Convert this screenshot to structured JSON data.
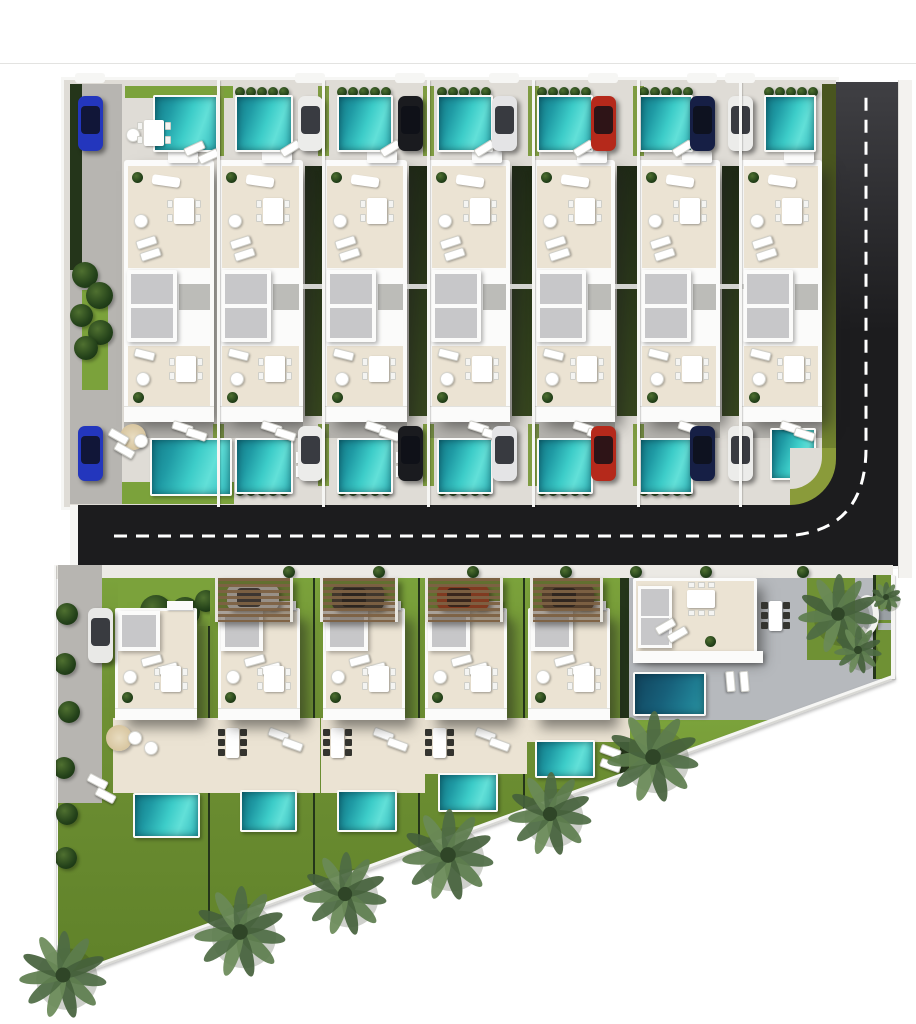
{
  "title": "villa-development-site-plan",
  "palette": {
    "white": "#fbfbfa",
    "wall": "#f6f6f4",
    "concrete": "#dfdcd6",
    "beige": "#ebe3d3",
    "skylight": "#c7c7c9",
    "road": "#1c1c1e",
    "dash": "#ffffff",
    "lawn": "#6f9134",
    "lawnB": "#7ba23b",
    "lawnStrip": "#7f9c42",
    "hedgeDark": "#24351a",
    "gapHedge1": "#1f2a16",
    "gapHedge2": "#37471f",
    "olive": "#8a9b3a",
    "drive": "#b7b5b1",
    "sidewalk": "#eceae5",
    "glass": "rgba(12,15,22,0.80)",
    "walkway": "#bcbcb8",
    "greyTerrace": "#b6b9bd"
  },
  "hairline_y": 63,
  "road": {
    "vertical": [
      836,
      82,
      62,
      486
    ],
    "horizontal": [
      78,
      505,
      820,
      63
    ],
    "dash_path": "M114 536 H 778 Q 866 536 866 448 V 94",
    "bottom_wall": [
      78,
      566,
      820,
      3
    ],
    "left_cap": [
      70,
      505,
      8,
      64
    ],
    "right_sidewalk": [
      898,
      80,
      14,
      498
    ]
  },
  "top_parcel": {
    "x": 64,
    "y": 80,
    "w": 772,
    "h": 427,
    "margin": [
      {
        "t": "rect",
        "b": [
          6,
          4,
          52,
          420
        ],
        "c": "drive"
      },
      {
        "t": "rect",
        "b": [
          6,
          4,
          12,
          186
        ],
        "c": "hedgeDark"
      },
      {
        "t": "rect",
        "b": [
          18,
          210,
          26,
          100
        ],
        "c": "lawnB"
      },
      {
        "t": "bush",
        "b": [
          8,
          182,
          26
        ]
      },
      {
        "t": "bush",
        "b": [
          22,
          202,
          27
        ]
      },
      {
        "t": "bush",
        "b": [
          6,
          224,
          23
        ]
      },
      {
        "t": "bush",
        "b": [
          24,
          240,
          25
        ]
      },
      {
        "t": "bush",
        "b": [
          10,
          256,
          24
        ]
      },
      {
        "t": "rect",
        "b": [
          758,
          4,
          14,
          418
        ],
        "c": "oliveGrad"
      }
    ],
    "columns": [
      {
        "name": "villa-1",
        "x0": 6,
        "x1": 154,
        "bldg": [
          60,
          90
        ],
        "pool": [
          89,
          65
        ],
        "pool_b": [
          86,
          358,
          82,
          58
        ],
        "car_x": 14,
        "car": "#2336bd",
        "std": false,
        "hedges": false,
        "extras": [
          {
            "t": "rect",
            "b": [
              61,
              6,
              108,
              12
            ],
            "c": "lawnB"
          },
          {
            "t": "roundtable",
            "b": [
              62,
              48
            ]
          },
          {
            "t": "diningW",
            "b": [
              80,
              40
            ]
          },
          {
            "t": "lounger",
            "b": [
              120,
              64,
              -25
            ]
          },
          {
            "t": "lounger",
            "b": [
              134,
              72,
              -25
            ]
          },
          {
            "t": "parasol",
            "b": [
              56,
              344
            ]
          },
          {
            "t": "roundtable",
            "b": [
              70,
              354
            ]
          },
          {
            "t": "lounger",
            "b": [
              44,
              352,
              30
            ]
          },
          {
            "t": "lounger",
            "b": [
              50,
              366,
              30
            ]
          },
          {
            "t": "rect",
            "b": [
              58,
              402,
              112,
              22
            ],
            "c": "lawnB"
          }
        ]
      },
      {
        "name": "villa-2",
        "x0": 154,
        "x1": 259,
        "bldg": [
          154,
          85
        ],
        "pool": [
          171,
          58
        ],
        "car_x": 234,
        "car": "#ececea",
        "std": true,
        "hedges": true,
        "extras": []
      },
      {
        "name": "villa-3",
        "x0": 259,
        "x1": 364,
        "bldg": [
          259,
          84
        ],
        "pool": [
          273,
          56
        ],
        "car_x": 334,
        "car": "#1a1b1f",
        "std": true,
        "hedges": true,
        "extras": []
      },
      {
        "name": "villa-4",
        "x0": 364,
        "x1": 469,
        "bldg": [
          364,
          82
        ],
        "pool": [
          373,
          56
        ],
        "car_x": 428,
        "car": "#e4e4e6",
        "std": true,
        "hedges": true,
        "extras": []
      },
      {
        "name": "villa-5",
        "x0": 469,
        "x1": 574,
        "bldg": [
          469,
          82
        ],
        "pool": [
          473,
          56
        ],
        "car_x": 527,
        "car": "#b5291b",
        "std": true,
        "hedges": true,
        "extras": []
      },
      {
        "name": "villa-6",
        "x0": 574,
        "x1": 678,
        "bldg": [
          574,
          82
        ],
        "pool": [
          575,
          54
        ],
        "car_x": 626,
        "car": "#161f45",
        "std": true,
        "hedges": true,
        "extras": []
      },
      {
        "name": "villa-7",
        "x0": 676,
        "x1": 758,
        "bldg": [
          676,
          82
        ],
        "pool": [
          700,
          52
        ],
        "pool_b": [
          706,
          348,
          46,
          52
        ],
        "car_x": 664,
        "car": "#ececea",
        "std": false,
        "hedges": true,
        "extras": [
          {
            "t": "rect",
            "b": [
              726,
              368,
              46,
              59
            ],
            "c": "road"
          },
          {
            "t": "quad",
            "b": [
              726,
              368,
              46,
              57
            ]
          },
          {
            "t": "quadIn",
            "b": [
              726,
              368,
              32,
              41
            ]
          }
        ]
      }
    ]
  },
  "bottom_parcel": {
    "x": 40,
    "y": 565,
    "w": 860,
    "h": 450,
    "clip": "polygon(14px 0px, 853px 0px, 853px 113px, 14px 417px)",
    "sidewalk": [
      14,
      0,
      839,
      14
    ],
    "sidewalk_bushes": [
      243,
      333,
      427,
      520,
      590,
      660,
      757
    ],
    "ivy": [
      [
        16,
        38
      ],
      [
        14,
        88
      ],
      [
        18,
        136
      ],
      [
        13,
        192
      ],
      [
        16,
        238
      ],
      [
        15,
        282
      ]
    ],
    "lots": [
      {
        "name": "villa-8",
        "x0": 18,
        "x1": 170,
        "bldg": [
          75,
          82
        ],
        "pool": [
          93,
          228,
          67,
          45
        ],
        "patio_h": 75,
        "patio_f": false,
        "extras": [
          {
            "t": "rect",
            "b": [
              18,
              0,
              44,
              238
            ],
            "c": "drive"
          },
          {
            "t": "carV",
            "b": [
              48,
              43
            ],
            "c": "#e9e9e7"
          },
          {
            "t": "rect",
            "b": [
              78,
              13,
              92,
              48
            ],
            "c": "lawnB"
          },
          {
            "t": "bush",
            "b": [
              100,
              30,
              32
            ]
          },
          {
            "t": "bush",
            "b": [
              130,
              32,
              30
            ]
          },
          {
            "t": "bush",
            "b": [
              155,
              25,
              22
            ]
          },
          {
            "t": "parasol",
            "b": [
              66,
              160
            ]
          },
          {
            "t": "roundtable",
            "b": [
              88,
              166
            ]
          },
          {
            "t": "roundtable",
            "b": [
              104,
              176
            ]
          },
          {
            "t": "lounger",
            "b": [
              47,
              212,
              28
            ]
          },
          {
            "t": "lounger",
            "b": [
              55,
              226,
              28
            ]
          }
        ]
      },
      {
        "name": "villa-9",
        "x0": 170,
        "x1": 275,
        "bldg": [
          178,
          82
        ],
        "pergola": [
          175,
          78
        ],
        "pcar": "#dcdcda",
        "pool": [
          200,
          225,
          57,
          42
        ],
        "patio_h": 75,
        "patio_f": true,
        "extras": []
      },
      {
        "name": "villa-10",
        "x0": 275,
        "x1": 380,
        "bldg": [
          283,
          82
        ],
        "pergola": [
          280,
          78
        ],
        "pcar": "#3a3734",
        "pool": [
          297,
          225,
          60,
          42
        ],
        "patio_h": 75,
        "patio_f": true,
        "extras": []
      },
      {
        "name": "villa-11",
        "x0": 380,
        "x1": 485,
        "bldg": [
          385,
          82
        ],
        "pergola": [
          385,
          78
        ],
        "pcar": "#b0401f",
        "pool": [
          398,
          208,
          60,
          39
        ],
        "patio_h": 56,
        "patio_f": true,
        "extras": []
      },
      {
        "name": "villa-12",
        "x0": 485,
        "x1": 582,
        "bldg": [
          488,
          82
        ],
        "pergola": [
          490,
          73
        ],
        "pcar": "#5a4433",
        "pool": [
          495,
          175,
          60,
          38
        ],
        "patio_h": 24,
        "patio_f": false,
        "extras": [
          {
            "t": "lounger",
            "b": [
              560,
              182,
              20
            ]
          },
          {
            "t": "lounger",
            "b": [
              560,
              196,
              20
            ]
          }
        ]
      }
    ],
    "corner_lot": {
      "name": "corner-villa",
      "terrace": [
        588,
        13,
        252,
        146
      ],
      "lawn_below": [
        588,
        155,
        265,
        240
      ],
      "palm_lawn": [
        767,
        13,
        48,
        82
      ],
      "right_lawn": [
        833,
        10,
        20,
        104
      ],
      "bldg": [
        593,
        13,
        124,
        80
      ],
      "white_band": [
        593,
        86,
        130,
        12
      ],
      "pool": [
        593,
        107,
        73,
        44
      ],
      "extras": [
        {
          "t": "lounger",
          "b": [
            680,
            112,
            85
          ]
        },
        {
          "t": "lounger",
          "b": [
            694,
            112,
            85
          ]
        },
        {
          "t": "diningD",
          "b": [
            729,
            36
          ]
        },
        {
          "t": "sculpt",
          "b": [
            815,
            30
          ]
        },
        {
          "t": "rect",
          "b": [
            838,
            44,
            17,
            11
          ],
          "c": "#9aa0a4"
        },
        {
          "t": "rect",
          "b": [
            838,
            58,
            17,
            7
          ],
          "c": "#b3b8bb"
        }
      ]
    },
    "b5_corner_hedge": [
      582,
      13,
      7,
      300
    ],
    "left_wall": [
      12,
      0,
      4,
      418
    ]
  },
  "diagonal_wall": {
    "x": 54,
    "y": 979,
    "len": 894,
    "angle_deg": -19.93
  },
  "right_wall": [
    891,
    575,
    4,
    104
  ],
  "palms": [
    [
      63,
      975,
      44
    ],
    [
      240,
      932,
      46
    ],
    [
      345,
      894,
      42
    ],
    [
      448,
      855,
      46
    ],
    [
      550,
      814,
      42
    ],
    [
      653,
      757,
      46
    ],
    [
      838,
      614,
      40
    ],
    [
      858,
      650,
      24
    ],
    [
      886,
      597,
      15
    ]
  ],
  "templates": {
    "upper_furniture": [
      [
        "canopy",
        44,
        -9
      ],
      [
        "plant",
        8,
        12
      ],
      [
        "sofa",
        28,
        16,
        8
      ],
      [
        "roundtable",
        10,
        54
      ],
      [
        "diningW",
        -40,
        38
      ],
      [
        "lounger",
        12,
        78,
        -18
      ],
      [
        "lounger",
        16,
        90,
        -18
      ],
      [
        "skylight",
        3,
        110
      ],
      [
        "walkway",
        55,
        124
      ],
      [
        "lounger",
        10,
        190,
        14
      ],
      [
        "roundtable",
        12,
        212
      ],
      [
        "diningW",
        -38,
        196
      ],
      [
        "plant",
        9,
        232
      ]
    ],
    "lower_furniture": [
      [
        "skylight2",
        3,
        3
      ],
      [
        "lounger",
        26,
        48,
        -15
      ],
      [
        "lounger",
        42,
        56,
        -15
      ],
      [
        "roundtable",
        8,
        62
      ],
      [
        "diningW",
        -36,
        58
      ],
      [
        "plant",
        7,
        84
      ]
    ],
    "corner_furniture": [
      [
        "skylightV",
        5,
        8
      ],
      [
        "diningW6",
        54,
        12
      ],
      [
        "lounger",
        22,
        44,
        -30
      ],
      [
        "lounger",
        34,
        52,
        -30
      ],
      [
        "plant",
        72,
        58
      ]
    ],
    "patio_furniture": [
      [
        "diningD",
        10,
        10
      ],
      [
        "lounger",
        52,
        12,
        20
      ],
      [
        "lounger",
        66,
        22,
        20
      ]
    ]
  }
}
